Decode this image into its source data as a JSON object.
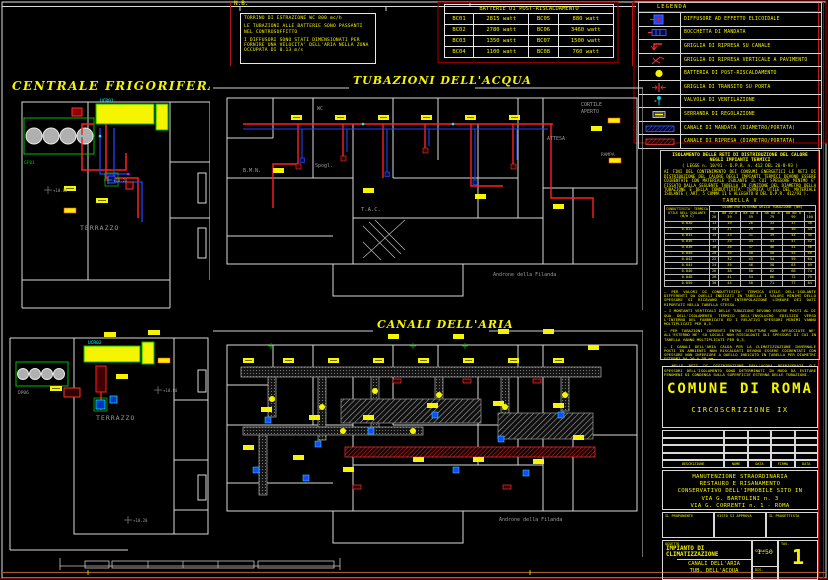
{
  "colors": {
    "yellow": "#f5f500",
    "red": "#ff2020",
    "dark_red": "#8b0000",
    "blue": "#2040ff",
    "cyan": "#00ffff",
    "green": "#00c000",
    "wall_white": "#d8d8d8",
    "gray_text": "#9a9a9a",
    "orange_border": "#a85a28"
  },
  "nb": {
    "title": "N.B.",
    "lines": [
      "TORRINO DI ESTRAZIONE WC   800 mc/h",
      "LE TUBAZIONI ALLE BATTERIE SONO PASSANTI NEL CONTROSOFFITTO",
      "I DIFFUSORI SONO STATI DIMENSIONATI PER FORNIRE UNA VELOCITA' DELL'ARIA NELLA ZONA OCCUPATA DI 0.13 m/s"
    ]
  },
  "battery_table": {
    "title": "BATTERIE DI POST-RISCALDAMENTO",
    "rows": [
      [
        "BC01",
        "2815 watt",
        "BC05",
        "880 watt"
      ],
      [
        "BC02",
        "2780 watt",
        "BC06",
        "3460 watt"
      ],
      [
        "BC03",
        "1350 watt",
        "BC07",
        "1500 watt"
      ],
      [
        "BC04",
        "1100 watt",
        "BC08",
        "760 watt"
      ]
    ]
  },
  "legend": {
    "title": "LEGENDA",
    "items": [
      {
        "icon": "diffusore-elicoidale-icon",
        "label": "DIFFUSORE AD EFFETTO ELICOIDALE"
      },
      {
        "icon": "bocchetta-mandata-icon",
        "label": "BOCCHETTA DI MANDATA"
      },
      {
        "icon": "griglia-ripresa-canale-icon",
        "label": "GRIGLIA DI RIPRESA SU CANALE"
      },
      {
        "icon": "griglia-ripresa-pavimento-icon",
        "label": "GRIGLIA DI RIPRESA VERTICALE A PAVIMENTO"
      },
      {
        "icon": "batteria-post-riscaldamento-icon",
        "label": "BATTERIA DI POST-RISCALDAMENTO"
      },
      {
        "icon": "griglia-transito-porta-icon",
        "label": "GRIGLIA DI TRANSITO SU PORTA"
      },
      {
        "icon": "valvola-ventilazione-icon",
        "label": "VALVOLA DI VENTILAZIONE"
      },
      {
        "icon": "serranda-regolazione-icon",
        "label": "SERRANDA DI REGOLAZIONE"
      },
      {
        "icon": "canale-mandata-icon",
        "label": "CANALE DI MANDATA   (DIAMETRO/PORTATA)"
      },
      {
        "icon": "canale-ripresa-icon",
        "label": "CANALE DI RIPRESA   (DIAMETRO/PORTATA)"
      }
    ]
  },
  "plans": {
    "centrale1": {
      "title": "CENTRALE FRIGORIFERA",
      "terrazzo": "TERRAZZO",
      "level_a": "+10.80",
      "level_b": "+10.20",
      "pump_label": "GF01",
      "chiller_label": "UCR01"
    },
    "centrale2": {
      "terrazzo": "TERRAZZO",
      "level_a": "+10.80",
      "level_b": "+10.20",
      "pump_label": "DP06",
      "chiller_label": "UCR02"
    },
    "water": {
      "title": "TUBAZIONI DELL'ACQUA",
      "room_labels": {
        "wc": "WC",
        "spogl": "Spogl.",
        "bmn": "B.M.N.",
        "tac": "T.A.C.",
        "attesa": "ATTESA",
        "cortile_1": "CORTILE",
        "cortile_2": "APERTO",
        "rampa": "RAMPA",
        "androne": "Androne della Filanda"
      }
    },
    "air": {
      "title": "CANALI DELL'ARIA",
      "androne": "Androne della Filanda"
    }
  },
  "iso": {
    "title_1": "ISOLAMENTO DELLE RETI DI DISTRIBUZIONE DEL CALORE",
    "title_2": "NEGLI IMPIANTI TERMICI",
    "title_3": "( LEGGE n. 10/91 - D.P.R. n. 412 DEL 26-8-93 )",
    "intro": "AI FINI DEL CONTENIMENTO DEI CONSUMI ENERGETICI LE RETI DI DISTRIBUZIONE DEL CALORE DEGLI IMPIANTI TERMICI DEVONO ESSERE COIBENTATE CON MATERIALE ISOLANTE IL CUI SPESSORE MINIMO E' FISSATO DALLA SEGUENTE TABELLA IN FUNZIONE DEL DIAMETRO DELLA TUBAZIONE E DELLA CONDUTTIVITA' TERMICA UTILE DEL MATERIALE ISOLANTE ( ART. 5 COMMA 11 E ALLEGATO B DEL D.P.R. 412/93 ).",
    "table_title": "TABELLA V",
    "table": {
      "corner": "CONDUTTIVITA' TERMICA UTILE DELL'ISOLANTE (W/m C)",
      "span": "DIAMETRO ESTERNO DELLA TUBAZIONE (mm)",
      "cols": [
        "< 20",
        "da 20 a 39",
        "da 40 a 59",
        "da 60 a 79",
        "da 80 a 99",
        "> 100"
      ],
      "rows": [
        [
          "0.030",
          "13",
          "19",
          "26",
          "33",
          "37",
          "40"
        ],
        [
          "0.032",
          "14",
          "21",
          "29",
          "36",
          "40",
          "44"
        ],
        [
          "0.034",
          "15",
          "23",
          "31",
          "39",
          "44",
          "48"
        ],
        [
          "0.036",
          "17",
          "25",
          "34",
          "43",
          "47",
          "52"
        ],
        [
          "0.038",
          "18",
          "28",
          "37",
          "46",
          "51",
          "56"
        ],
        [
          "0.040",
          "20",
          "30",
          "40",
          "50",
          "55",
          "60"
        ],
        [
          "0.042",
          "22",
          "32",
          "43",
          "54",
          "59",
          "64"
        ],
        [
          "0.044",
          "24",
          "35",
          "46",
          "58",
          "63",
          "69"
        ],
        [
          "0.046",
          "26",
          "38",
          "50",
          "62",
          "68",
          "74"
        ],
        [
          "0.048",
          "28",
          "41",
          "54",
          "66",
          "72",
          "79"
        ],
        [
          "0.050",
          "30",
          "44",
          "58",
          "71",
          "77",
          "84"
        ]
      ]
    },
    "notes": [
      "PER VALORI DI CONDUTTIVITA' TERMICA UTILE DELL'ISOLANTE DIFFERENTI DA QUELLI INDICATI IN TABELLA I VALORI MINIMI DELLO SPESSORE SI RICAVANO PER INTERPOLAZIONE LINEARE DEI DATI RIPORTATI NELLA TABELLA STESSA.",
      "I MONTANTI VERTICALI DELLE TUBAZIONI DEVONO ESSERE POSTI AL DI QUA DELL'ISOLAMENTO TERMICO DELL'INVOLUCRO EDILIZIO VERSO L'INTERNO DEL FABBRICATO ED I RELATIVI SPESSORI MINIMI VANNO MOLTIPLICATI PER 0,5.",
      "PER TUBAZIONI CORRENTI ENTRO STRUTTURE NON AFFACCIATE NE' ALL'ESTERNO NE' SU LOCALI NON RISCALDATI GLI SPESSORI DI CUI IN TABELLA VANNO MOLTIPLICATI PER 0,3.",
      "I CANALI DELL'ARIA CALDA PER LA CLIMATIZZAZIONE INVERNALE POSTI IN AMBIENTI NON RISCALDATI DEVONO ESSERE COIBENTATI CON SPESSORE NON INFERIORE A QUELLO INDICATO IN TABELLA PER DIAMETRI ESTERNI DA 20 A 39 mm.",
      "NELLE RETI DI DISTRIBUZIONE DELL'ACQUA REFRIGERATA GLI SPESSORI DELL'ISOLAMENTO SONO DETERMINATI IN MODO DA EVITARE FENOMENI DI CONDENSA SULLA SUPERFICIE ESTERNA DELLE TUBAZIONI."
    ]
  },
  "title_block": {
    "comune": "COMUNE DI ROMA",
    "circoscrizione": "CIRCOSCRIZIONE IX",
    "rev_headers": [
      "DESCRIZIONE",
      "NOME",
      "DATA",
      "FIRMA",
      "DATA"
    ],
    "oggetto_lines": [
      "MANUTENZIONE STRAORDINARIA",
      "RESTAURO E RISANAMENTO",
      "CONSERVATIVO DELL'IMMOBILE  SITO IN",
      "VIA G. BARTOLINI  n. 3",
      "VIA G. CORRENTI  n. 1  -  ROMA"
    ],
    "sig_labels": [
      "IL PROPONENTE",
      "VISTO SI APPROVA",
      "IL PROGETTISTA"
    ],
    "cart": {
      "oggetto_label": "OGGETTO",
      "impianto_1": "IMPIANTO DI",
      "impianto_2": "CLIMATIZZAZIONE",
      "content_1": "CANALI DELL'ARIA",
      "content_2": "TUB. DELL'ACQUA",
      "scala_label": "SCALA",
      "scala": "1:50",
      "dis_label": "DIS.",
      "tav_label": "TAV.",
      "tav": "1"
    }
  }
}
